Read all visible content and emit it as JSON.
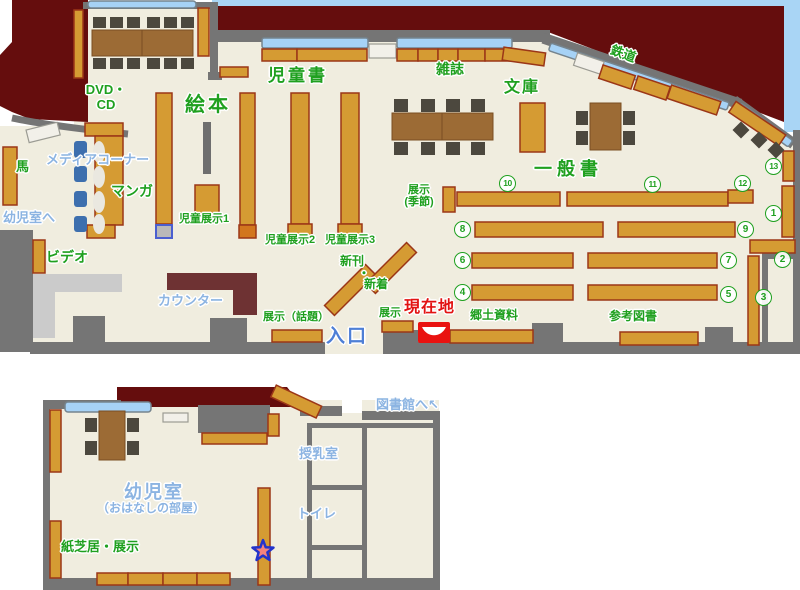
{
  "map": {
    "type": "library-floor-map",
    "floors": [
      "main-floor",
      "kids-room"
    ]
  },
  "labels": {
    "jidosho": "児童書",
    "ehon": "絵本",
    "zasshi": "雑誌",
    "bunko": "文庫",
    "tetsudo": "鉄道",
    "ippansho": "一 般 書",
    "dvd_cd": "DVD・\nCD",
    "media_corner": "メディアコーナー",
    "manga": "マンガ",
    "uma": "馬",
    "yojishitsu_e": "幼児室へ",
    "video": "ビデオ",
    "counter": "カウンター",
    "jido_tenji1": "児童展示1",
    "jido_tenji2": "児童展示2",
    "jido_tenji3": "児童展示3",
    "shinkan": "新刊",
    "shinkan_dot": "・",
    "shinchaku": "新着",
    "tenji_kisetsu": "展示\n(季節)",
    "tenji_wadai": "展示（話題）",
    "tenji": "展示",
    "genzaichi": "現在地",
    "iriguchi": "入口",
    "kyodo_shiryo": "郷土資料",
    "sanko_tosho": "参考図書",
    "toshokan_e": "図書館へ",
    "toshokan_arrow": "↖",
    "junyushitsu": "授乳室",
    "toilet": "トイレ",
    "yojishitsu": "幼児室",
    "ohanashi": "（おはなしの部屋）",
    "kamishibai": "紙芝居・展示"
  },
  "shelf_numbers": [
    "1",
    "2",
    "3",
    "4",
    "5",
    "6",
    "7",
    "8",
    "9",
    "10",
    "11",
    "12",
    "13"
  ],
  "colors": {
    "outside_building": "#650D0D",
    "sky": "#A9D5F5",
    "wall": "#757575",
    "floor": "#F0EDDF",
    "shelf": "#D59B33",
    "shelf_border": "#9B3617",
    "table": "#9C6B35",
    "chair_dark": "#4C483E",
    "chair_blue": "#3D6FAE",
    "window": "#A6D2F6",
    "counter_gray": "#CBCBCB",
    "counter_dark": "#6E3233",
    "label_green": "#1FA01F",
    "label_lightblue": "#8CB4E2",
    "label_red": "#E21312",
    "entrance_blue": "#4E7FD6",
    "marker_red": "#E91210",
    "star_fill": "#F4837E",
    "star_border": "#2233CC"
  }
}
